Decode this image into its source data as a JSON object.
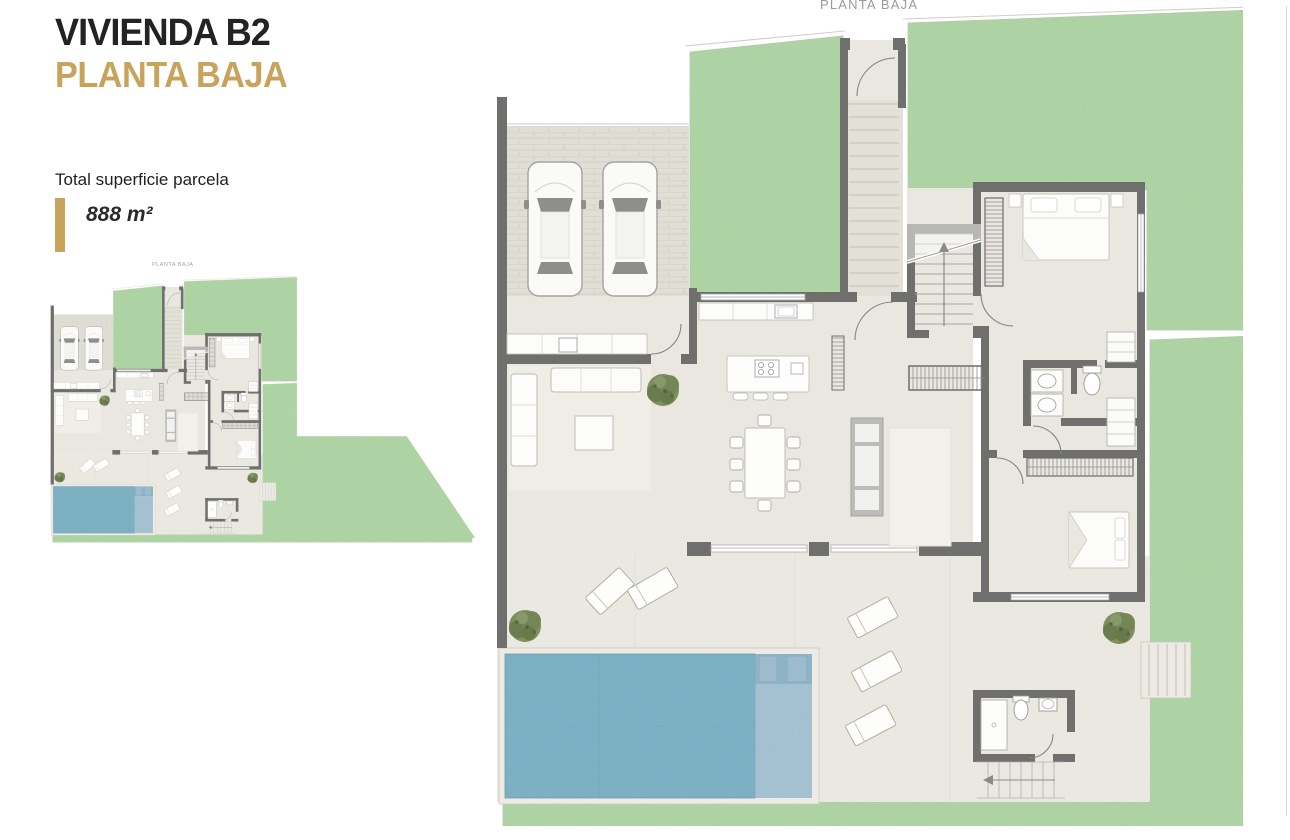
{
  "header": {
    "title": "VIVIENDA B2",
    "subtitle": "PLANTA BAJA"
  },
  "area": {
    "label": "Total superficie parcela",
    "value": "888 m²"
  },
  "thumbnail_plan": {
    "label": "PLANTA BAJA"
  },
  "main_plan": {
    "label": "PLANTA BAJA"
  },
  "colors": {
    "accent_gold": "#c8a35c",
    "title_text": "#232323",
    "plan_label_gray": "#9b9b9b",
    "garden_green": "#b0d5a6",
    "pool_deep_blue": "#7db0c4",
    "pool_shallow_blue": "#a6c3d2",
    "wall_gray": "#6f6f6d",
    "floor_beige": "#e9e7e0",
    "paving_gray": "#e1ded5"
  },
  "plan_depicts": [
    "garage with two cars",
    "entry stairs",
    "garden lawns",
    "kitchen with island",
    "dining table",
    "living room sofa",
    "interior staircase",
    "bedroom",
    "second bedroom",
    "bathroom",
    "wardrobes",
    "terrace with sun loungers",
    "swimming pool",
    "pool bathroom",
    "outdoor stairs",
    "trees"
  ]
}
